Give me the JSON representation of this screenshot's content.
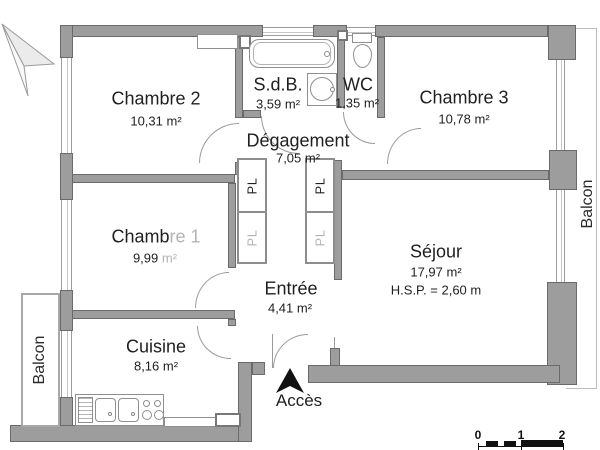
{
  "rooms": {
    "chambre2": {
      "label": "Chambre 2",
      "area": "10,31 m²"
    },
    "sdb": {
      "label": "S.d.B.",
      "area": "3,59 m²"
    },
    "wc": {
      "label": "WC",
      "area": "1,35 m²"
    },
    "chambre3": {
      "label": "Chambre 3",
      "area": "10,78 m²"
    },
    "degagement": {
      "label": "Dégagement",
      "area": "7,05 m²"
    },
    "chambre1": {
      "label_part1": "Chamb",
      "label_part2": "re 1",
      "area_part1": "9,99 ",
      "area_part2": "m²"
    },
    "sejour": {
      "label": "Séjour",
      "area": "17,97 m²",
      "ceiling": "H.S.P. = 2,60 m"
    },
    "entree": {
      "label": "Entrée",
      "area": "4,41 m²"
    },
    "cuisine": {
      "label": "Cuisine",
      "area": "8,16 m²"
    }
  },
  "closets": {
    "pl_top_left": "PL",
    "pl_bottom_left": "PL",
    "pl_top_right": "PL",
    "pl_bottom_right": "PL"
  },
  "balconies": {
    "left": "Balcon",
    "right": "Balcon"
  },
  "access": {
    "label": "Accès"
  },
  "scale_bar": {
    "ticks": [
      "0",
      "1",
      "2"
    ]
  },
  "colors": {
    "wall": "#9d9d9d",
    "wall_outline": "#6a6a6a",
    "text": "#1f1f1f",
    "faded_text": "#b3b3b3",
    "scale": "#111111"
  }
}
